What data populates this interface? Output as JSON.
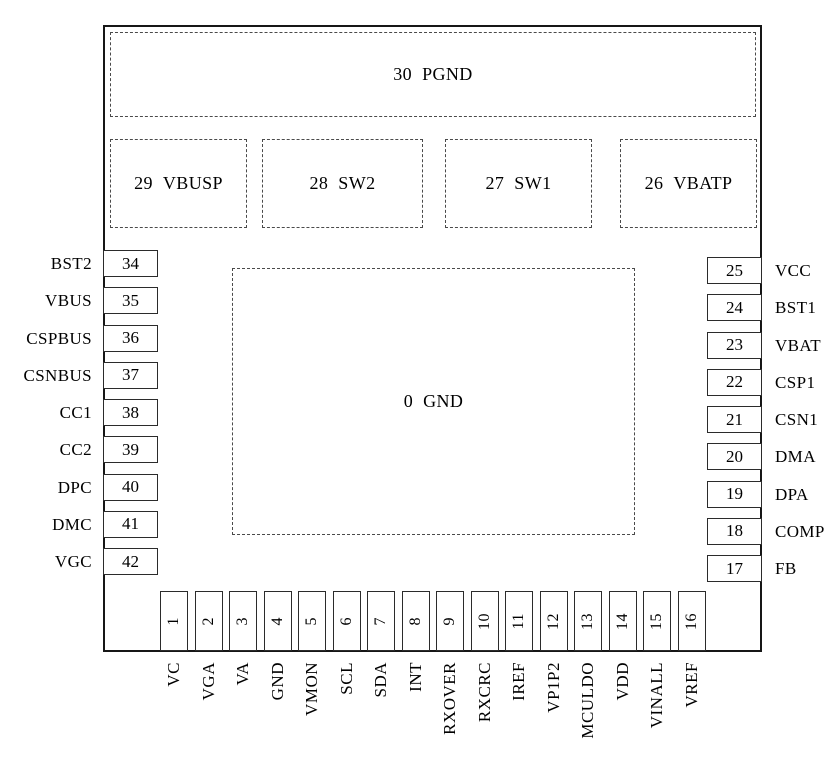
{
  "diagram": {
    "kind": "ic-pinout",
    "background": "#ffffff",
    "outline_color": "#161616",
    "dash_color": "#4a4a4a",
    "text_color": "#000000"
  },
  "chip": {
    "top_pad": {
      "number": "30",
      "name": "PGND"
    },
    "upper_pads": [
      {
        "number": "29",
        "name": "VBUSP"
      },
      {
        "number": "28",
        "name": "SW2"
      },
      {
        "number": "27",
        "name": "SW1"
      },
      {
        "number": "26",
        "name": "VBATP"
      }
    ],
    "center_pad": {
      "number": "0",
      "name": "GND"
    },
    "left_pins": [
      {
        "number": "34",
        "name": "BST2"
      },
      {
        "number": "35",
        "name": "VBUS"
      },
      {
        "number": "36",
        "name": "CSPBUS"
      },
      {
        "number": "37",
        "name": "CSNBUS"
      },
      {
        "number": "38",
        "name": "CC1"
      },
      {
        "number": "39",
        "name": "CC2"
      },
      {
        "number": "40",
        "name": "DPC"
      },
      {
        "number": "41",
        "name": "DMC"
      },
      {
        "number": "42",
        "name": "VGC"
      }
    ],
    "right_pins": [
      {
        "number": "25",
        "name": "VCC"
      },
      {
        "number": "24",
        "name": "BST1"
      },
      {
        "number": "23",
        "name": "VBAT"
      },
      {
        "number": "22",
        "name": "CSP1"
      },
      {
        "number": "21",
        "name": "CSN1"
      },
      {
        "number": "20",
        "name": "DMA"
      },
      {
        "number": "19",
        "name": "DPA"
      },
      {
        "number": "18",
        "name": "COMP"
      },
      {
        "number": "17",
        "name": "FB"
      }
    ],
    "bottom_pins": [
      {
        "number": "1",
        "name": "VC"
      },
      {
        "number": "2",
        "name": "VGA"
      },
      {
        "number": "3",
        "name": "VA"
      },
      {
        "number": "4",
        "name": "GND"
      },
      {
        "number": "5",
        "name": "VMON"
      },
      {
        "number": "6",
        "name": "SCL"
      },
      {
        "number": "7",
        "name": "SDA"
      },
      {
        "number": "8",
        "name": "INT"
      },
      {
        "number": "9",
        "name": "RXOVER"
      },
      {
        "number": "10",
        "name": "RXCRC"
      },
      {
        "number": "11",
        "name": "IREF"
      },
      {
        "number": "12",
        "name": "VP1P2"
      },
      {
        "number": "13",
        "name": "MCULDO"
      },
      {
        "number": "14",
        "name": "VDD"
      },
      {
        "number": "15",
        "name": "VINALL"
      },
      {
        "number": "16",
        "name": "VREF"
      }
    ]
  }
}
